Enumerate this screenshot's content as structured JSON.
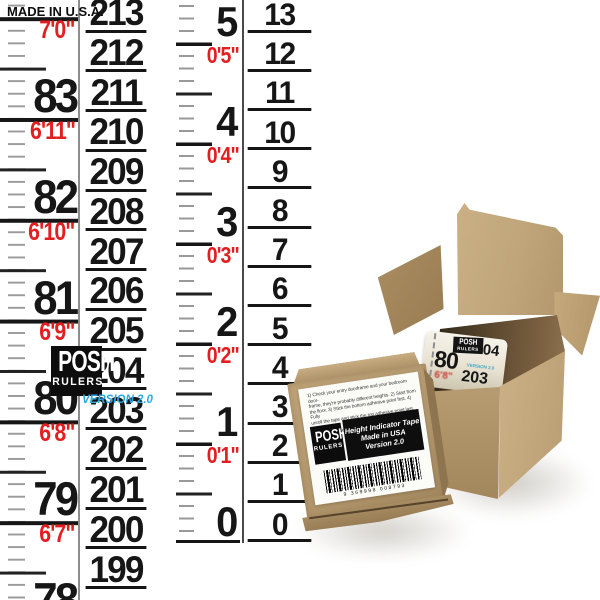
{
  "page": {
    "made_in": "MADE IN U.S.A."
  },
  "brand": {
    "top": "POSH",
    "bottom": "RULERS",
    "version": "VERSION 2.0"
  },
  "colors": {
    "red": "#e41e20",
    "blue": "#2aabe2",
    "kraft": "#b89b70",
    "black": "#161616"
  },
  "strip1": {
    "inch_numbers": [
      "83",
      "82",
      "81",
      "80",
      "79",
      "78"
    ],
    "feet_labels": [
      "7'0\"",
      "6'11\"",
      "6'10\"",
      "6'9\"",
      "6'8\"",
      "6'7\""
    ],
    "cm_numbers": [
      "213",
      "212",
      "211",
      "210",
      "209",
      "208",
      "207",
      "206",
      "205",
      "204",
      "203",
      "202",
      "201",
      "200",
      "199"
    ]
  },
  "strip2": {
    "inch_numbers": [
      "5",
      "4",
      "3",
      "2",
      "1",
      "0"
    ],
    "feet_labels": [
      "0'5\"",
      "0'4\"",
      "0'3\"",
      "0'2\"",
      "0'1\""
    ],
    "cm_numbers": [
      "13",
      "12",
      "11",
      "10",
      "9",
      "8",
      "7",
      "6",
      "5",
      "4",
      "3",
      "2",
      "1",
      "0"
    ]
  },
  "box_front": {
    "label": {
      "instructions": [
        "1) Check your entry doorframe and your bedroom door-",
        "frame, they're probably different heights. 2) Start from",
        "the floor. 3) Stick the bottom adhesive point first. 4) Fully",
        "unroll the tape and stick the top adhesive point last. 5)",
        "Cut tape to size, if necessary. 6) Rate on Amazon. Thanks."
      ],
      "logo_top": "POSH",
      "logo_bottom": "RULERS",
      "info_lines": [
        "Height Indicator Tape",
        "Made in USA",
        "Version 2.0"
      ],
      "barcode_digits": "9 369998 008793"
    }
  },
  "box_open": {
    "roll": {
      "logo_top": "POSH",
      "logo_bottom": "RULERS",
      "number_04": "04",
      "number_80": "80",
      "red_label": "6'8\"",
      "version": "VERSION 2.0",
      "number_203": "203"
    }
  }
}
